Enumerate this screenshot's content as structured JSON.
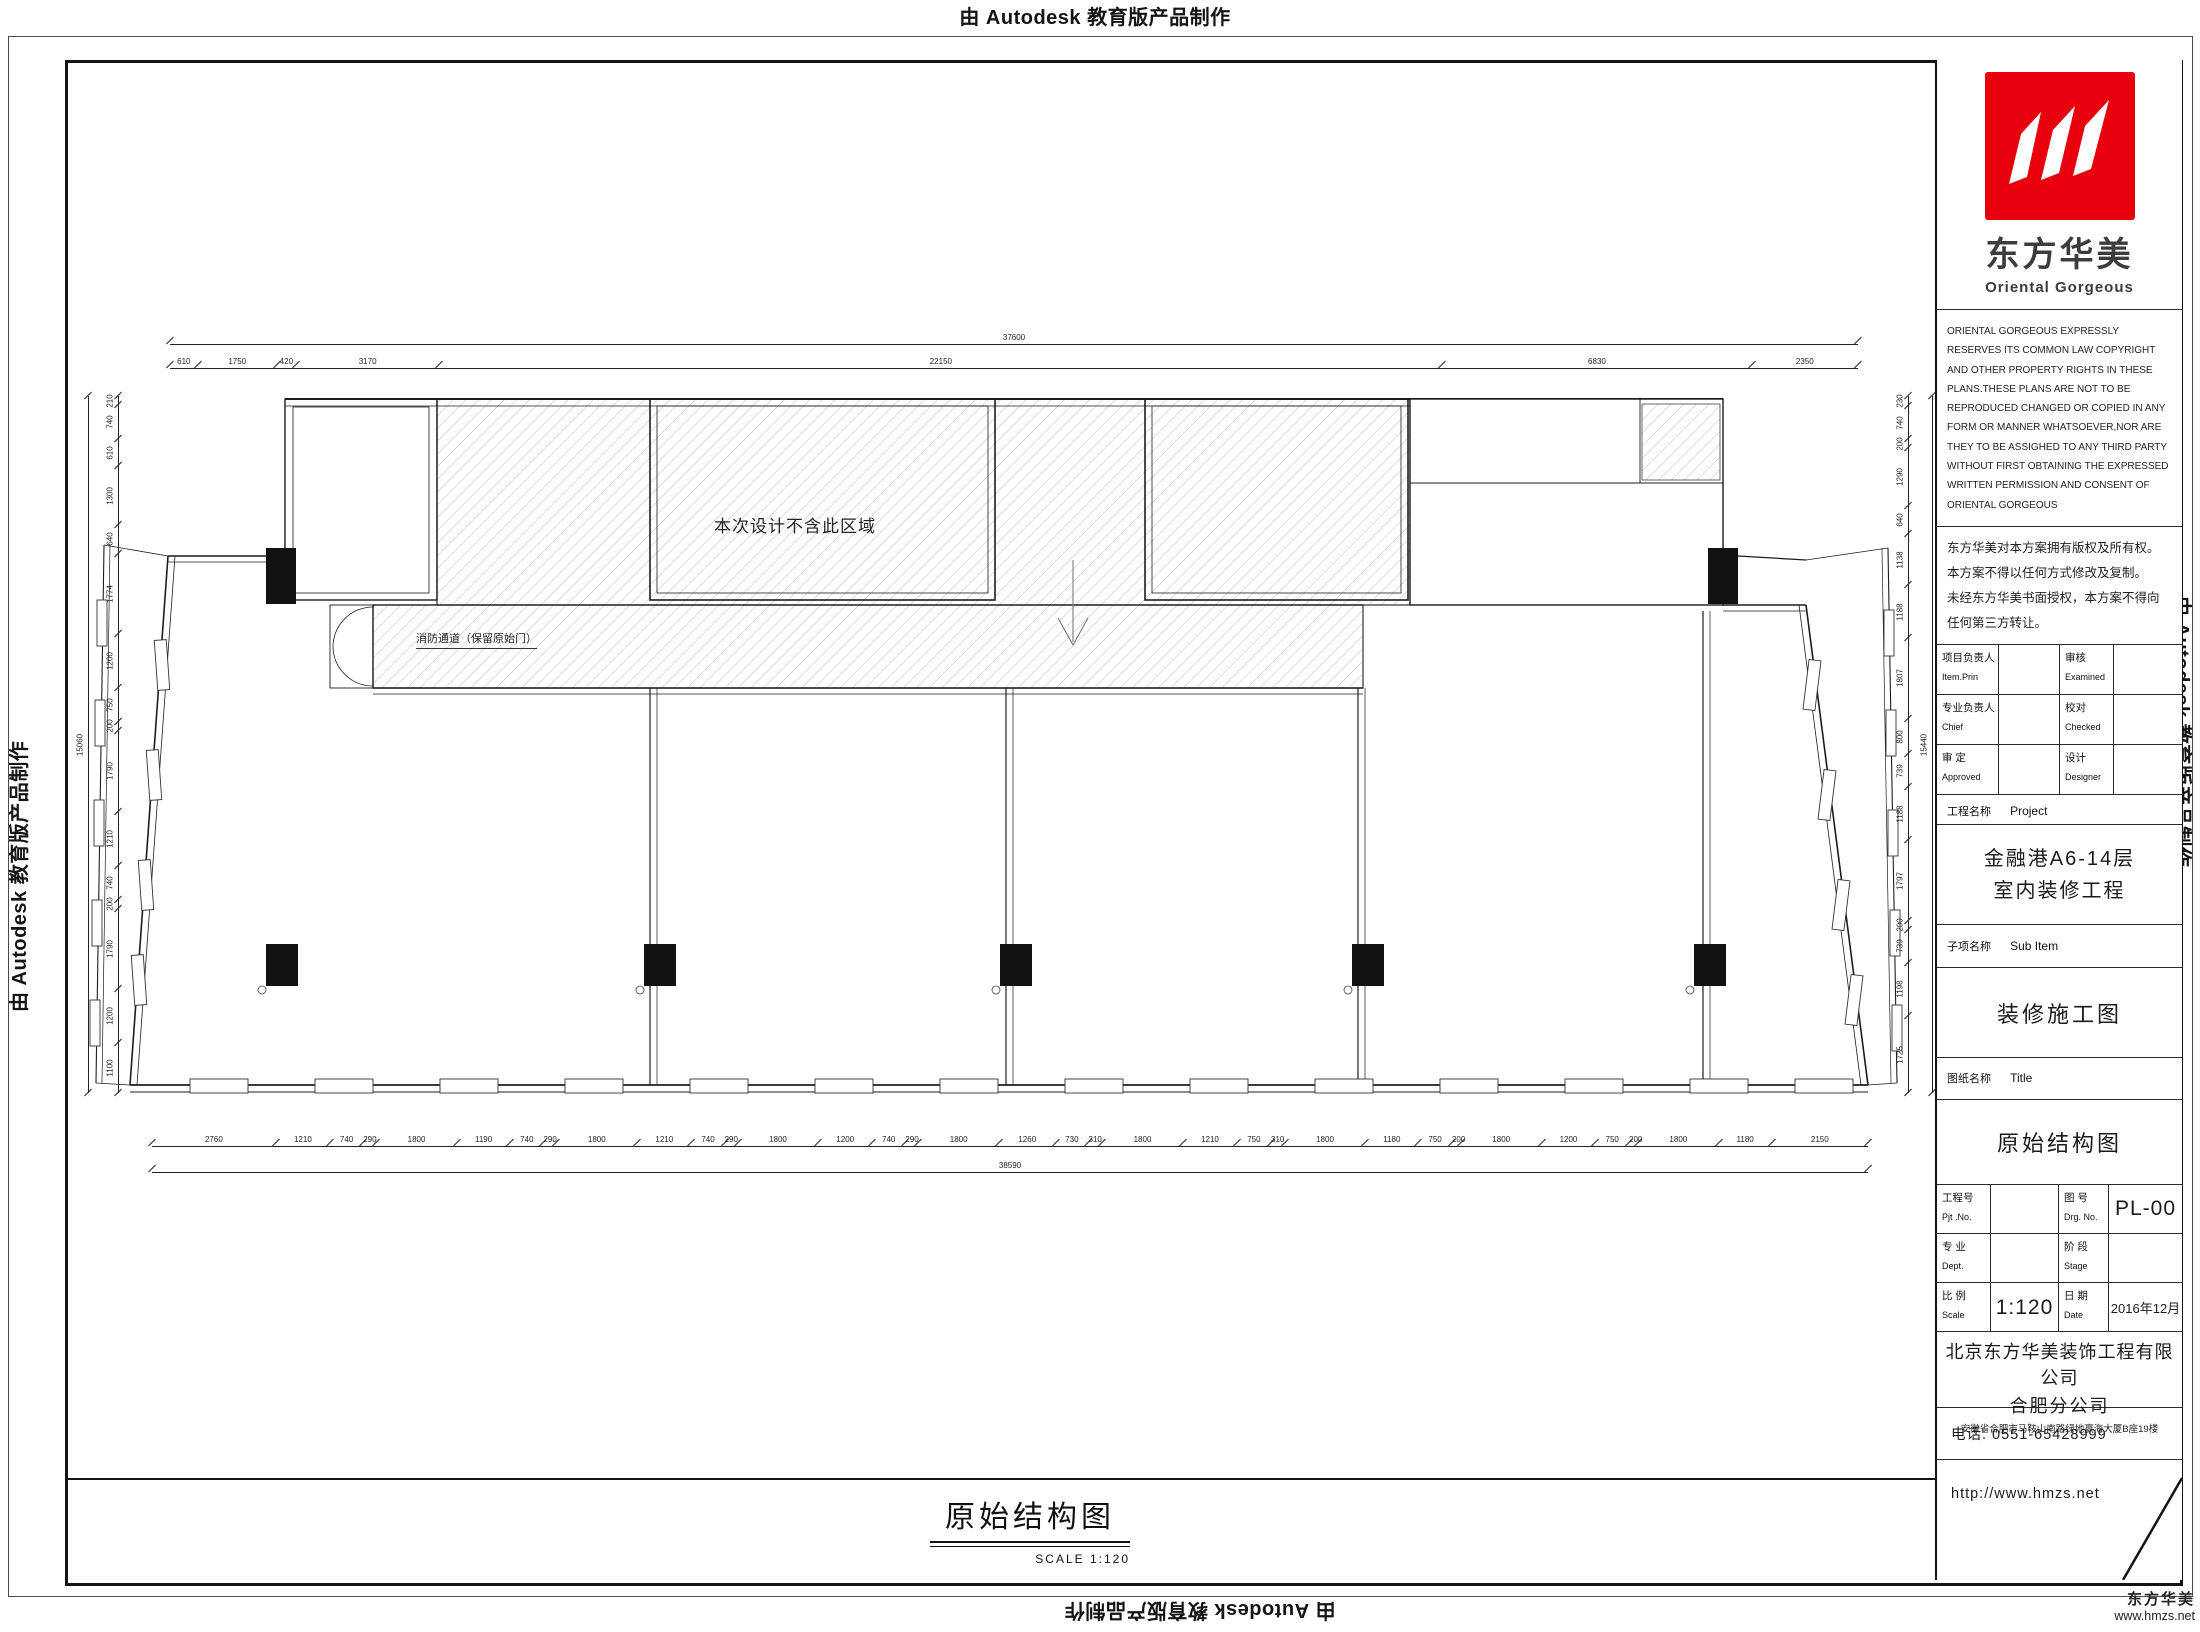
{
  "edge_marks": {
    "autodesk": "由 Autodesk 教育版产品制作"
  },
  "plan": {
    "excluded_label": "本次设计不含此区域",
    "fire_label": "消防通道（保留原始门）",
    "dims": {
      "top_total": [
        "37600"
      ],
      "top": [
        "610",
        "1750",
        "420",
        "3170",
        "22150",
        "6830",
        "2350"
      ],
      "bottom": [
        "2760",
        "1210",
        "740",
        "290",
        "1800",
        "1190",
        "740",
        "290",
        "1800",
        "1210",
        "740",
        "290",
        "1800",
        "1200",
        "740",
        "290",
        "1800",
        "1260",
        "730",
        "310",
        "1800",
        "1210",
        "750",
        "310",
        "1800",
        "1180",
        "750",
        "200",
        "1800",
        "1200",
        "750",
        "200",
        "1800",
        "1180",
        "2150"
      ],
      "bottom_total": [
        "38590"
      ],
      "left": [
        "210",
        "740",
        "610",
        "1300",
        "640",
        "1774",
        "1200",
        "750",
        "200",
        "1790",
        "1210",
        "740",
        "200",
        "1790",
        "1200",
        "1100"
      ],
      "left_total": [
        "15060"
      ],
      "right": [
        "230",
        "740",
        "200",
        "1290",
        "640",
        "1138",
        "1188",
        "1807",
        "800",
        "739",
        "1188",
        "1797",
        "200",
        "739",
        "1198",
        "1725"
      ],
      "right_total": [
        "15440"
      ]
    }
  },
  "sheet_footer": {
    "title": "原始结构图",
    "scale": "SCALE  1:120"
  },
  "title_block": {
    "brand": {
      "cn": "东方华美",
      "en": "Oriental Gorgeous",
      "red": "#e8000d"
    },
    "copyright_en": "ORIENTAL GORGEOUS EXPRESSLY RESERVES ITS COMMON LAW COPYRIGHT AND OTHER PROPERTY RIGHTS IN THESE PLANS.THESE PLANS ARE NOT TO BE REPRODUCED CHANGED OR COPIED IN ANY FORM OR MANNER WHATSOEVER,NOR ARE THEY TO BE ASSIGHED TO ANY THIRD PARTY WITHOUT FIRST OBTAINING THE EXPRESSED WRITTEN PERMISSION AND CONSENT OF ORIENTAL GORGEOUS",
    "copyright_cn": [
      "东方华美对本方案拥有版权及所有权。",
      "本方案不得以任何方式修改及复制。",
      "未经东方华美书面授权，本方案不得向",
      "任何第三方转让。"
    ],
    "personnel": [
      {
        "c1": "项目负责人",
        "e1": "Item.Prin",
        "v1": "",
        "c2": "审核",
        "e2": "Examined",
        "v2": ""
      },
      {
        "c1": "专业负责人",
        "e1": "Chief",
        "v1": "",
        "c2": "校对",
        "e2": "Checked",
        "v2": ""
      },
      {
        "c1": "审 定",
        "e1": "Approved",
        "v1": "",
        "c2": "设计",
        "e2": "Designer",
        "v2": ""
      }
    ],
    "project_label_cn": "工程名称",
    "project_label_en": "Project",
    "project_name": [
      "金融港A6-14层",
      "室内装修工程"
    ],
    "subitem_label_cn": "子项名称",
    "subitem_label_en": "Sub Item",
    "set_title": "装修施工图",
    "sheet_label_cn": "图纸名称",
    "sheet_label_en": "Title",
    "sheet_name": "原始结构图",
    "meta": [
      {
        "c1": "工程号",
        "e1": "Pjt .No.",
        "v1": "",
        "c2": "图 号",
        "e2": "Drg. No.",
        "v2": "PL-00"
      },
      {
        "c1": "专 业",
        "e1": "Dept.",
        "v1": "",
        "c2": "阶 段",
        "e2": "Stage",
        "v2": ""
      },
      {
        "c1": "比 例",
        "e1": "Scale",
        "v1": "1:120",
        "c2": "日 期",
        "e2": "Date",
        "v2": "2016年12月"
      }
    ],
    "company": {
      "name": "北京东方华美装饰工程有限公司",
      "branch": "合肥分公司",
      "address": "安徽省合肥市马鞍山南路绿地赢海大厦B座19楼"
    },
    "phone": "电话: 0551-65428999",
    "website": "http://www.hmzs.net"
  },
  "corner_mark": {
    "brand": "东方华美",
    "site": "www.hmzs.net"
  }
}
